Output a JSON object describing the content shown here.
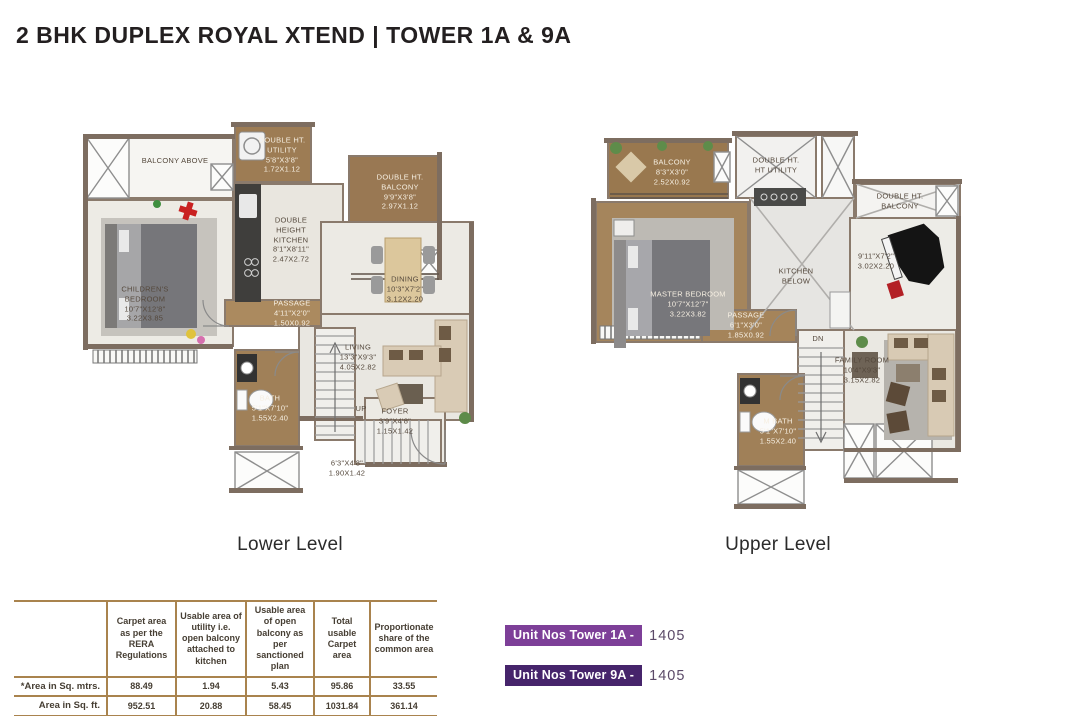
{
  "header": {
    "title": "2 BHK DUPLEX ROYAL XTEND | TOWER 1A & 9A"
  },
  "plans": {
    "lower": {
      "caption": "Lower Level",
      "rooms": {
        "balcony_above": {
          "name": "BALCONY ABOVE"
        },
        "utility": {
          "name": "DOUBLE HT. UTILITY",
          "ft": "5'8\"X3'8\"",
          "m": "1.72X1.12"
        },
        "kitchen": {
          "name": "DOUBLE HEIGHT KITCHEN",
          "ft": "8'1\"X8'11\"",
          "m": "2.47X2.72"
        },
        "dbl_balcony": {
          "name": "DOUBLE HT. BALCONY",
          "ft": "9'9\"X3'8\"",
          "m": "2.97X1.12"
        },
        "childrens_bedroom": {
          "name": "CHILDREN'S BEDROOM",
          "ft": "10'7\"X12'8\"",
          "m": "3.22X3.85"
        },
        "dining": {
          "name": "DINING",
          "ft": "10'3\"X7'2\"",
          "m": "3.12X2.20"
        },
        "passage": {
          "name": "PASSAGE",
          "ft": "4'11\"X2'0\"",
          "m": "1.50X0.92"
        },
        "living": {
          "name": "LIVING",
          "ft": "13'3\"X9'3\"",
          "m": "4.05X2.82"
        },
        "bath": {
          "name": "BATH",
          "ft": "5'1\"X7'10\"",
          "m": "1.55X2.40"
        },
        "up": {
          "name": "UP"
        },
        "foyer": {
          "name": "FOYER",
          "ft": "3'9\"X4'8\"",
          "m": "1.15X1.42"
        },
        "stair": {
          "ft": "6'3\"X4'8\"",
          "m": "1.90X1.42"
        }
      }
    },
    "upper": {
      "caption": "Upper Level",
      "rooms": {
        "balcony": {
          "name": "BALCONY",
          "ft": "8'3\"X3'0\"",
          "m": "2.52X0.92"
        },
        "utility": {
          "name": "DOUBLE HT. HT UTILITY"
        },
        "master_bedroom": {
          "name": "MASTER BEDROOM",
          "ft": "10'7\"X12'7\"",
          "m": "3.22X3.82"
        },
        "kitchen_below": {
          "name": "KITCHEN BELOW"
        },
        "dbl_balcony": {
          "name": "DOUBLE HT. BALCONY"
        },
        "open_dim": {
          "ft": "9'11\"X7'2\"",
          "m": "3.02X2.20"
        },
        "passage": {
          "name": "PASSAGE",
          "ft": "6'1\"X3'0\"",
          "m": "1.85X0.92"
        },
        "dn": {
          "name": "DN"
        },
        "m_bath": {
          "name": "M BATH",
          "ft": "5'1\"X7'10\"",
          "m": "1.55X2.40"
        },
        "family_room": {
          "name": "FAMILY ROOM",
          "ft": "10'4\"X9'3\"",
          "m": "3.15X2.82"
        }
      }
    }
  },
  "table": {
    "col_headers": [
      "Carpet area as per the RERA Regulations",
      "Usable area of utility i.e. open balcony attached to kitchen",
      "Usable area of open balcony as per sanctioned plan",
      "Total usable Carpet area",
      "Proportionate share of the common area"
    ],
    "rows": [
      {
        "label": "*Area in Sq. mtrs.",
        "values": [
          "88.49",
          "1.94",
          "5.43",
          "95.86",
          "33.55"
        ]
      },
      {
        "label": "Area in Sq. ft.",
        "values": [
          "952.51",
          "20.88",
          "58.45",
          "1031.84",
          "361.14"
        ]
      }
    ]
  },
  "units": [
    {
      "label": "Unit Nos Tower 1A -",
      "number": "1405",
      "badge_color": "#7d3f98"
    },
    {
      "label": "Unit Nos Tower 9A -",
      "number": "1405",
      "badge_color": "#46246b"
    }
  ],
  "colors": {
    "table_rule": "#a9834e",
    "unit_number_text": "#5b4a68",
    "title_text": "#231f20"
  }
}
